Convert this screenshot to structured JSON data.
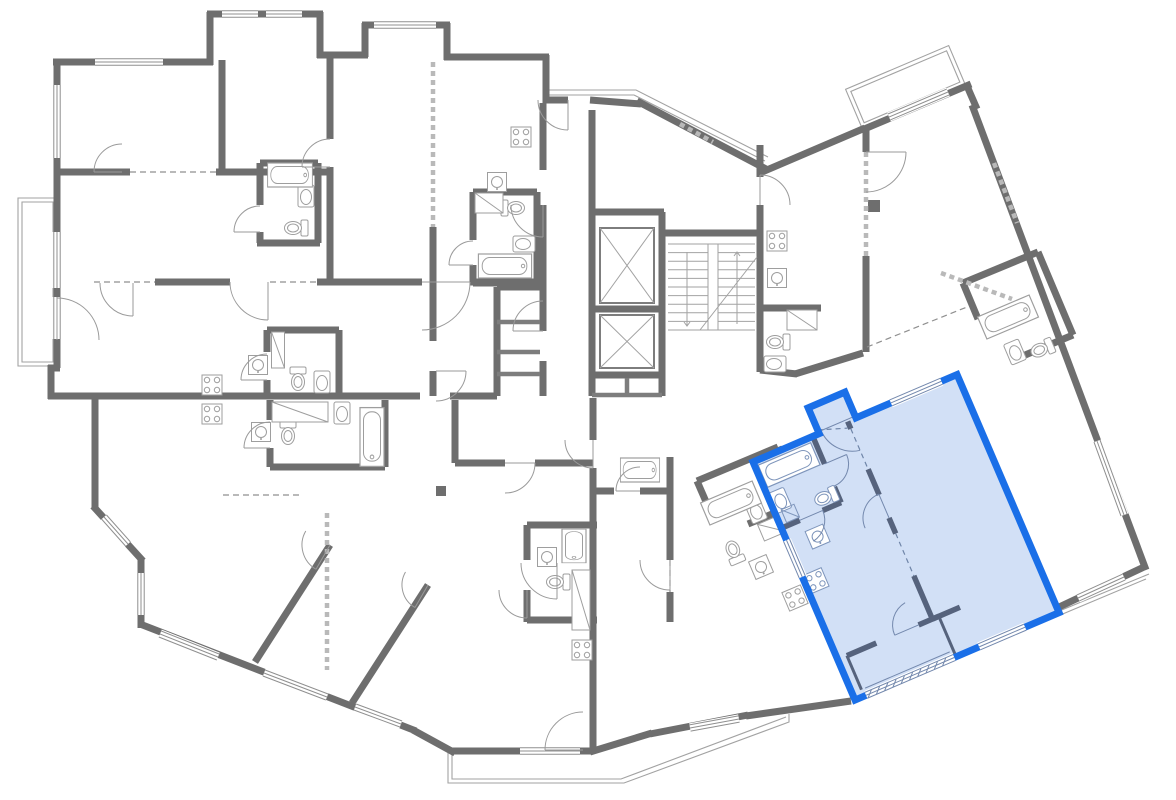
{
  "canvas": {
    "w": 1176,
    "h": 800,
    "bg": "#ffffff"
  },
  "palette": {
    "wall": "#6e6e6e",
    "medium": "#7d7d7d",
    "thin": "#a2a2a2",
    "fixture": "#9e9e9e",
    "dash": "#8f8f8f",
    "hatch": "#b9b9b9",
    "window_line": "#8f8f8f",
    "white": "#ffffff",
    "unit_border": "#1a6fe8",
    "unit_fill": "#d2e0f6",
    "unit_wall": "#56637d",
    "unit_thin": "#7388ad",
    "unit_fixture": "#7e95bb",
    "unit_dash": "#6f85a8"
  },
  "plan": {
    "walls": [
      [
        57,
        368,
        57,
        60
      ],
      [
        53,
        62,
        213,
        62
      ],
      [
        210,
        65,
        210,
        12
      ],
      [
        207,
        14,
        323,
        14
      ],
      [
        320,
        12,
        320,
        58
      ],
      [
        317,
        55,
        368,
        55
      ],
      [
        365,
        57,
        365,
        23
      ],
      [
        362,
        25,
        450,
        25
      ],
      [
        447,
        23,
        447,
        60
      ],
      [
        444,
        57,
        549,
        57
      ],
      [
        546,
        55,
        546,
        103
      ],
      [
        543,
        100,
        568,
        100
      ],
      [
        590,
        100,
        641,
        104
      ],
      [
        637,
        101,
        766,
        169
      ],
      [
        762,
        172,
        865,
        128
      ],
      [
        862,
        130,
        971,
        84
      ],
      [
        967,
        86,
        977,
        109
      ],
      [
        972,
        105,
        1146,
        570
      ],
      [
        1146,
        566,
        1057,
        608
      ],
      [
        851,
        701,
        746,
        716
      ],
      [
        748,
        715,
        650,
        734
      ],
      [
        652,
        733,
        590,
        752
      ],
      [
        593,
        751,
        451,
        751
      ],
      [
        455,
        753,
        413,
        730
      ],
      [
        416,
        731,
        140,
        624
      ],
      [
        141,
        628,
        141,
        558
      ],
      [
        143,
        561,
        93,
        506
      ],
      [
        95,
        509,
        95,
        393
      ],
      [
        98,
        396,
        48,
        396
      ],
      [
        51,
        399,
        51,
        365
      ],
      [
        48,
        368,
        60,
        368
      ],
      [
        57,
        172,
        130,
        172
      ],
      [
        216,
        172,
        333,
        172
      ],
      [
        222,
        60,
        222,
        172
      ],
      [
        330,
        57,
        330,
        139
      ],
      [
        330,
        167,
        330,
        284
      ],
      [
        260,
        163,
        318,
        163
      ],
      [
        260,
        163,
        260,
        205
      ],
      [
        260,
        232,
        260,
        243
      ],
      [
        257,
        243,
        320,
        243
      ],
      [
        318,
        163,
        318,
        243
      ],
      [
        155,
        282,
        230,
        282
      ],
      [
        317,
        282,
        422,
        282
      ],
      [
        470,
        282,
        546,
        282
      ],
      [
        51,
        396,
        420,
        396
      ],
      [
        450,
        396,
        497,
        396
      ],
      [
        543,
        103,
        543,
        170
      ],
      [
        543,
        205,
        543,
        331
      ],
      [
        543,
        361,
        543,
        396
      ],
      [
        497,
        287,
        497,
        396
      ],
      [
        497,
        287,
        540,
        287
      ],
      [
        433,
        227,
        433,
        341
      ],
      [
        433,
        371,
        433,
        396
      ],
      [
        592,
        110,
        592,
        212
      ],
      [
        590,
        212,
        664,
        212
      ],
      [
        592,
        212,
        592,
        376
      ],
      [
        662,
        212,
        662,
        376
      ],
      [
        590,
        375,
        664,
        375
      ],
      [
        592,
        309,
        662,
        309
      ],
      [
        592,
        376,
        592,
        396
      ],
      [
        662,
        376,
        662,
        396
      ],
      [
        662,
        233,
        762,
        233
      ],
      [
        760,
        145,
        760,
        177
      ],
      [
        760,
        205,
        760,
        372
      ],
      [
        763,
        308,
        821,
        308
      ],
      [
        866,
        128,
        866,
        152
      ],
      [
        866,
        256,
        866,
        352
      ],
      [
        760,
        370,
        797,
        374
      ],
      [
        795,
        374,
        863,
        353
      ],
      [
        670,
        457,
        670,
        560
      ],
      [
        670,
        592,
        670,
        622
      ],
      [
        593,
        398,
        593,
        440
      ],
      [
        593,
        468,
        593,
        751
      ],
      [
        455,
        463,
        505,
        463
      ],
      [
        535,
        463,
        593,
        463
      ],
      [
        455,
        400,
        455,
        463
      ],
      [
        255,
        662,
        330,
        545
      ],
      [
        352,
        703,
        428,
        585
      ],
      [
        527,
        525,
        527,
        560
      ],
      [
        527,
        590,
        527,
        622
      ],
      [
        527,
        525,
        597,
        525
      ],
      [
        527,
        620,
        597,
        620
      ],
      [
        595,
        491,
        614,
        491
      ],
      [
        640,
        491,
        668,
        491
      ],
      [
        473,
        192,
        473,
        240
      ],
      [
        473,
        265,
        473,
        283
      ],
      [
        473,
        192,
        537,
        192
      ],
      [
        537,
        192,
        537,
        283
      ],
      [
        473,
        283,
        537,
        283
      ],
      [
        267,
        330,
        267,
        352
      ],
      [
        267,
        380,
        267,
        395
      ],
      [
        267,
        330,
        339,
        330
      ],
      [
        339,
        330,
        339,
        395
      ],
      [
        270,
        400,
        270,
        420
      ],
      [
        270,
        448,
        270,
        467
      ],
      [
        385,
        400,
        385,
        467
      ],
      [
        270,
        467,
        385,
        467
      ],
      [
        697,
        481,
        778,
        447
      ],
      [
        778,
        447,
        801,
        502
      ],
      [
        748,
        524,
        801,
        502
      ],
      [
        697,
        481,
        707,
        504
      ],
      [
        963,
        283,
        1038,
        252
      ],
      [
        1038,
        252,
        1073,
        335
      ],
      [
        1073,
        335,
        1018,
        358
      ],
      [
        963,
        283,
        978,
        319
      ]
    ],
    "medium": [
      [
        497,
        322,
        540,
        322
      ],
      [
        497,
        352,
        540,
        352
      ],
      [
        497,
        374,
        540,
        374
      ],
      [
        627,
        378,
        627,
        396
      ],
      [
        592,
        395,
        662,
        395
      ]
    ],
    "blocks": [
      [
        436,
        486,
        10,
        10
      ],
      [
        868,
        200,
        12,
        12
      ]
    ],
    "thin_paths": [
      "M18,198 H57 V366 H18 Z",
      "M22,202 H53 V362 H22 Z",
      "M448,753 L448,783 L624,783 L789,722 L789,714",
      "M452,751 L452,779 L621,779 L786,717",
      "M549,95 L634,95 L765,161",
      "M549,90 L636,90 L768,157",
      "M1149,574 L1006,633",
      "M1146,579 L1008,637"
    ],
    "thin_rot": [
      {
        "t": [
          862,
          128
        ],
        "r": -23,
        "d": "M0,-42 H112 V0 H0 Z"
      },
      {
        "t": [
          862,
          128
        ],
        "r": -23,
        "d": "M4,-38 H108 V-4 H4 Z"
      }
    ],
    "hatched": [
      [
        433,
        62,
        433,
        227
      ],
      [
        327,
        513,
        327,
        670
      ],
      [
        866,
        152,
        866,
        256
      ],
      [
        941,
        273,
        1012,
        299
      ],
      [
        994,
        163,
        1017,
        223
      ],
      [
        680,
        124,
        713,
        142
      ]
    ],
    "dashed": [
      [
        94,
        282,
        155,
        282
      ],
      [
        270,
        282,
        317,
        282
      ],
      [
        130,
        172,
        216,
        172
      ],
      [
        223,
        495,
        300,
        495
      ],
      [
        867,
        347,
        967,
        307
      ],
      [
        670,
        560,
        670,
        592
      ]
    ],
    "windows": [
      [
        222,
        14,
        258,
        14
      ],
      [
        266,
        14,
        302,
        14
      ],
      [
        374,
        25,
        436,
        25
      ],
      [
        95,
        62,
        163,
        62
      ],
      [
        57,
        85,
        57,
        158
      ],
      [
        57,
        232,
        57,
        288
      ],
      [
        57,
        297,
        57,
        339
      ],
      [
        104,
        517,
        128,
        544
      ],
      [
        160,
        634,
        218,
        657
      ],
      [
        264,
        673,
        327,
        697
      ],
      [
        355,
        707,
        401,
        724
      ],
      [
        141,
        573,
        141,
        615
      ],
      [
        520,
        751,
        580,
        751
      ],
      [
        690,
        728,
        739,
        719
      ],
      [
        889,
        117,
        948,
        92
      ],
      [
        1097,
        441,
        1124,
        515
      ],
      [
        1124,
        577,
        1078,
        598
      ]
    ],
    "doors": [
      [
        57,
        340,
        42,
        -90,
        0
      ],
      [
        122,
        172,
        28,
        180,
        270
      ],
      [
        268,
        282,
        38,
        90,
        180
      ],
      [
        133,
        283,
        33,
        90,
        180
      ],
      [
        330,
        167,
        28,
        180,
        270
      ],
      [
        422,
        282,
        48,
        0,
        90
      ],
      [
        543,
        205,
        32,
        90,
        180
      ],
      [
        543,
        331,
        30,
        180,
        270
      ],
      [
        436,
        371,
        30,
        0,
        90
      ],
      [
        505,
        463,
        30,
        0,
        90
      ],
      [
        568,
        100,
        30,
        90,
        180
      ],
      [
        760,
        205,
        30,
        -90,
        0
      ],
      [
        866,
        152,
        40,
        0,
        90
      ],
      [
        670,
        560,
        30,
        90,
        180
      ],
      [
        593,
        440,
        28,
        90,
        180
      ],
      [
        557,
        563,
        36,
        90,
        180
      ],
      [
        583,
        750,
        38,
        180,
        270
      ],
      [
        330,
        545,
        28,
        120,
        210
      ],
      [
        428,
        585,
        26,
        120,
        210
      ],
      [
        260,
        232,
        26,
        180,
        270
      ],
      [
        473,
        265,
        24,
        180,
        270
      ],
      [
        267,
        380,
        26,
        180,
        270
      ],
      [
        270,
        448,
        26,
        180,
        270
      ],
      [
        527,
        590,
        28,
        90,
        180
      ],
      [
        640,
        491,
        24,
        180,
        270
      ]
    ],
    "stoves": [
      [
        212,
        385,
        0
      ],
      [
        212,
        414,
        0
      ],
      [
        521,
        137,
        0
      ],
      [
        777,
        241,
        0
      ],
      [
        582,
        650,
        0
      ],
      [
        795,
        598,
        -23
      ]
    ],
    "sinks_sq": [
      [
        258,
        365,
        0
      ],
      [
        261,
        432,
        0
      ],
      [
        497,
        182,
        0
      ],
      [
        777,
        278,
        0
      ],
      [
        547,
        557,
        0
      ],
      [
        761,
        567,
        -23
      ]
    ],
    "sinks_oval": [
      [
        306,
        196,
        0
      ],
      [
        322,
        382,
        0
      ],
      [
        342,
        413,
        0
      ],
      [
        524,
        244,
        90
      ],
      [
        775,
        364,
        90
      ],
      [
        756,
        511,
        -23
      ],
      [
        1015,
        352,
        -23
      ]
    ],
    "toilets": [
      [
        296,
        228,
        90
      ],
      [
        298,
        379,
        0
      ],
      [
        288,
        433,
        0
      ],
      [
        513,
        208,
        -90
      ],
      [
        778,
        342,
        90
      ],
      [
        558,
        582,
        90
      ],
      [
        734,
        552,
        157
      ],
      [
        1042,
        349,
        67
      ]
    ],
    "tubs": [
      [
        290,
        175,
        0,
        0.8
      ],
      [
        505,
        266,
        0,
        0.95
      ],
      [
        372,
        437,
        90,
        1.05
      ],
      [
        574,
        546,
        90,
        0.6
      ],
      [
        640,
        470,
        0,
        0.7
      ],
      [
        1008,
        317,
        -23,
        1.0
      ],
      [
        731,
        503,
        -23,
        1.0
      ]
    ],
    "wardrobes": [
      [
        278,
        350,
        13,
        36,
        0
      ],
      [
        300,
        412,
        56,
        20,
        0
      ],
      [
        489,
        203,
        28,
        20,
        0
      ],
      [
        802,
        320,
        30,
        20,
        0
      ],
      [
        581,
        600,
        18,
        60,
        0
      ],
      [
        772,
        528,
        24,
        18,
        -23
      ]
    ],
    "elevators": [
      [
        600,
        228,
        54,
        75
      ],
      [
        600,
        315,
        54,
        53
      ]
    ],
    "stairs": {
      "x": 668,
      "y": 244,
      "w": 87,
      "h": 86,
      "treads": 11,
      "stringer": [
        708,
        244,
        10,
        86
      ],
      "arrows": [
        [
          687,
          252,
          687,
          326
        ],
        [
          737,
          324,
          737,
          252
        ]
      ],
      "diag": [
        700,
        330,
        757,
        257
      ]
    }
  },
  "unit": {
    "origin": [
      753,
      462
    ],
    "angle": -23.2,
    "outline": "M0,0 L72,0 L72,-28 L112,-28 L112,0 L222,0 L222,259 L0,259 Z",
    "walls": [
      [
        65,
        0,
        65,
        30
      ],
      [
        65,
        55,
        65,
        72
      ],
      [
        0,
        72,
        20,
        72
      ],
      [
        45,
        72,
        65,
        72
      ],
      [
        103,
        0,
        103,
        8
      ],
      [
        103,
        52,
        103,
        80
      ],
      [
        103,
        105,
        103,
        122
      ],
      [
        103,
        168,
        103,
        215
      ],
      [
        103,
        215,
        133,
        215
      ],
      [
        10,
        215,
        42,
        215
      ],
      [
        88,
        215,
        110,
        215
      ]
    ],
    "medium": [
      [
        110,
        215,
        110,
        259
      ],
      [
        10,
        215,
        10,
        252
      ]
    ],
    "dashed": [
      [
        103,
        8,
        103,
        52
      ],
      [
        103,
        122,
        103,
        168
      ],
      [
        72,
        -4,
        100,
        6
      ]
    ],
    "windows": [
      [
        150,
        0,
        205,
        0
      ],
      [
        0,
        85,
        0,
        125
      ],
      [
        135,
        259,
        185,
        259
      ]
    ],
    "glazing": [
      12,
      259,
      108,
      259
    ],
    "thin_paths": [
      "M14,252 L106,252"
    ],
    "stoves": [
      [
        11,
        134,
        0
      ]
    ],
    "sinks_sq": [
      [
        30,
        94,
        0
      ]
    ],
    "sinks_oval": [
      [
        10,
        46,
        0
      ]
    ],
    "toilets": [
      [
        53,
        61,
        90
      ]
    ],
    "tubs": [
      [
        32,
        17,
        0,
        1.02
      ]
    ],
    "wardrobes": [
      [
        14,
        62,
        14,
        14,
        0
      ]
    ],
    "doors": [
      [
        20,
        72,
        25,
        0,
        80
      ],
      [
        103,
        105,
        26,
        -90,
        -180
      ],
      [
        109,
        -2,
        34,
        180,
        100
      ],
      [
        88,
        215,
        26,
        180,
        262
      ],
      [
        65,
        30,
        24,
        0,
        90
      ]
    ]
  }
}
